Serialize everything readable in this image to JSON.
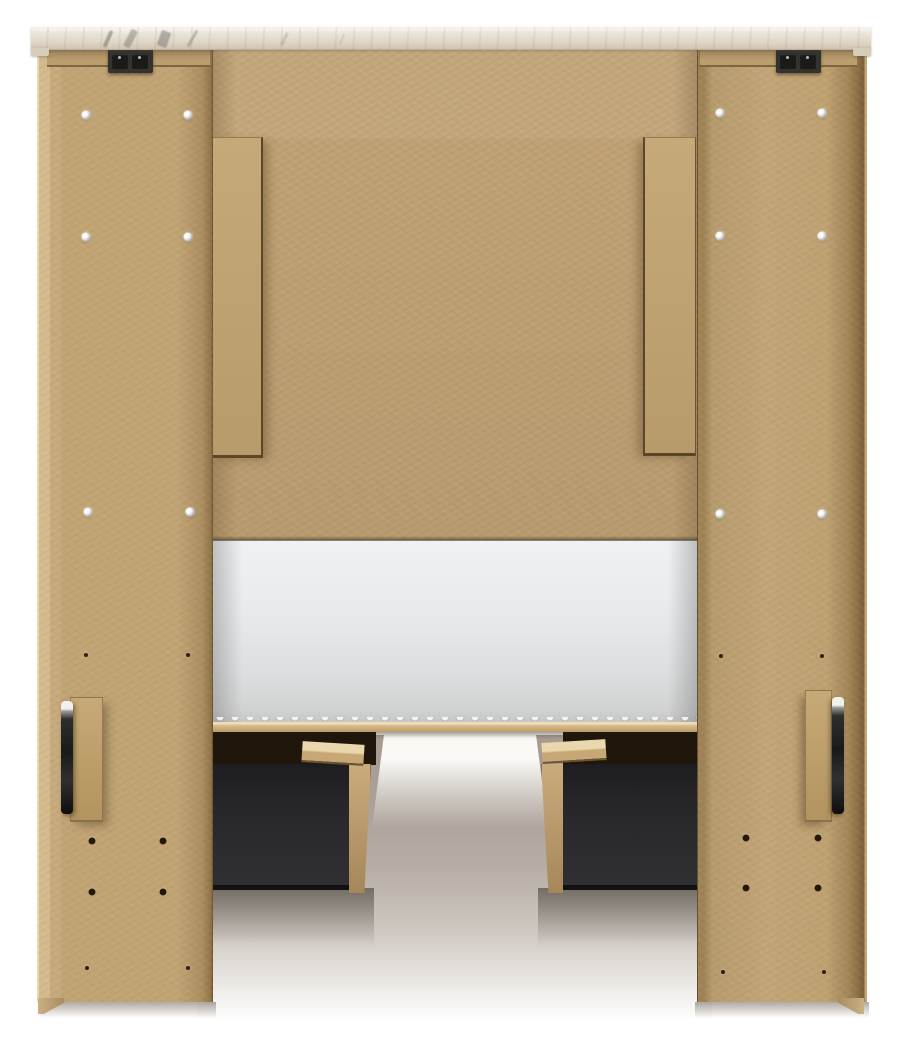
{
  "scene": {
    "subject": "back view of a storage bed: whitewashed top cap, two MDF bookcase piers, headboard back panel, white mattress and two dark under-bed storage drawers on a white studio floor",
    "drawer_count": 2,
    "handle_count": 2,
    "bracket_count": 2
  },
  "palette": {
    "bg": "#ffffff",
    "mdf_base": "#bfa173",
    "mdf_dark": "#a78a5d",
    "mdf_light": "#d4ba8c",
    "seam": "#5d4a2c",
    "cap_base": "#e9e4d8",
    "cap_shadow": "#cfc5b1",
    "vein": "#77756f",
    "bracket": "#34322e",
    "bracket_slot": "#1b1a18",
    "screw": "#e8e8e8",
    "hole": "#3a2b17",
    "mattress_light": "#f0f1f3",
    "mattress_dark": "#c6c7c6",
    "deck": "#d9bc8d",
    "underdeck": "#1f160c",
    "drawer": "#28282a",
    "drawer_side": "#bb9c6e",
    "rail_top": "#ead7ad",
    "handle": "#1b1b1b",
    "floor_shadow": "#a59b91",
    "glow": "#f7f5f2"
  },
  "fasteners": {
    "screws": [
      {
        "x": 86,
        "y": 115
      },
      {
        "x": 188,
        "y": 115
      },
      {
        "x": 86,
        "y": 237
      },
      {
        "x": 188,
        "y": 237
      },
      {
        "x": 88,
        "y": 512
      },
      {
        "x": 190,
        "y": 512
      },
      {
        "x": 720,
        "y": 113
      },
      {
        "x": 822,
        "y": 113
      },
      {
        "x": 720,
        "y": 236
      },
      {
        "x": 822,
        "y": 236
      },
      {
        "x": 720,
        "y": 514
      },
      {
        "x": 822,
        "y": 514
      }
    ],
    "holes_large": [
      {
        "x": 92,
        "y": 841
      },
      {
        "x": 163,
        "y": 841
      },
      {
        "x": 92,
        "y": 892
      },
      {
        "x": 163,
        "y": 892
      },
      {
        "x": 746,
        "y": 838
      },
      {
        "x": 818,
        "y": 838
      },
      {
        "x": 746,
        "y": 888
      },
      {
        "x": 818,
        "y": 888
      }
    ],
    "holes_small": [
      {
        "x": 86,
        "y": 655
      },
      {
        "x": 188,
        "y": 655
      },
      {
        "x": 87,
        "y": 968
      },
      {
        "x": 188,
        "y": 968
      },
      {
        "x": 721,
        "y": 656
      },
      {
        "x": 822,
        "y": 656
      },
      {
        "x": 723,
        "y": 972
      },
      {
        "x": 824,
        "y": 972
      }
    ]
  }
}
